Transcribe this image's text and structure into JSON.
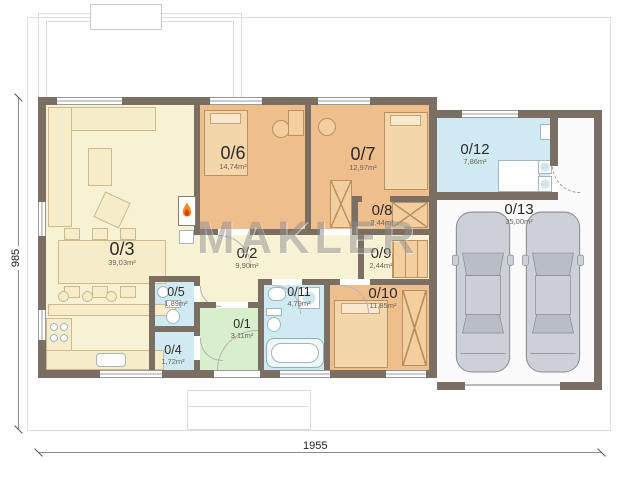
{
  "watermark": "MAKLER",
  "dimensions": {
    "height_label": "985",
    "width_label": "1955"
  },
  "rooms": [
    {
      "id": "0/1",
      "area": "3,11m²"
    },
    {
      "id": "0/2",
      "area": "9,90m²"
    },
    {
      "id": "0/3",
      "area": "39,03m²"
    },
    {
      "id": "0/4",
      "area": "1,72m²"
    },
    {
      "id": "0/5",
      "area": "1,89m²"
    },
    {
      "id": "0/6",
      "area": "14,74m²"
    },
    {
      "id": "0/7",
      "area": "12,97m²"
    },
    {
      "id": "0/8",
      "area": "2,44m²"
    },
    {
      "id": "0/9",
      "area": "2,44m²"
    },
    {
      "id": "0/10",
      "area": "11,85m²"
    },
    {
      "id": "0/11",
      "area": "4,79m²"
    },
    {
      "id": "0/12",
      "area": "7,86m²"
    },
    {
      "id": "0/13",
      "area": "35,00m²"
    }
  ],
  "colors": {
    "wall": "#7b6e62",
    "living": "#f8f2d4",
    "bedroom": "#efbe8d",
    "bath": "#cfeaf3",
    "entry": "#d9eecd",
    "garage": "#fbfbfc"
  }
}
